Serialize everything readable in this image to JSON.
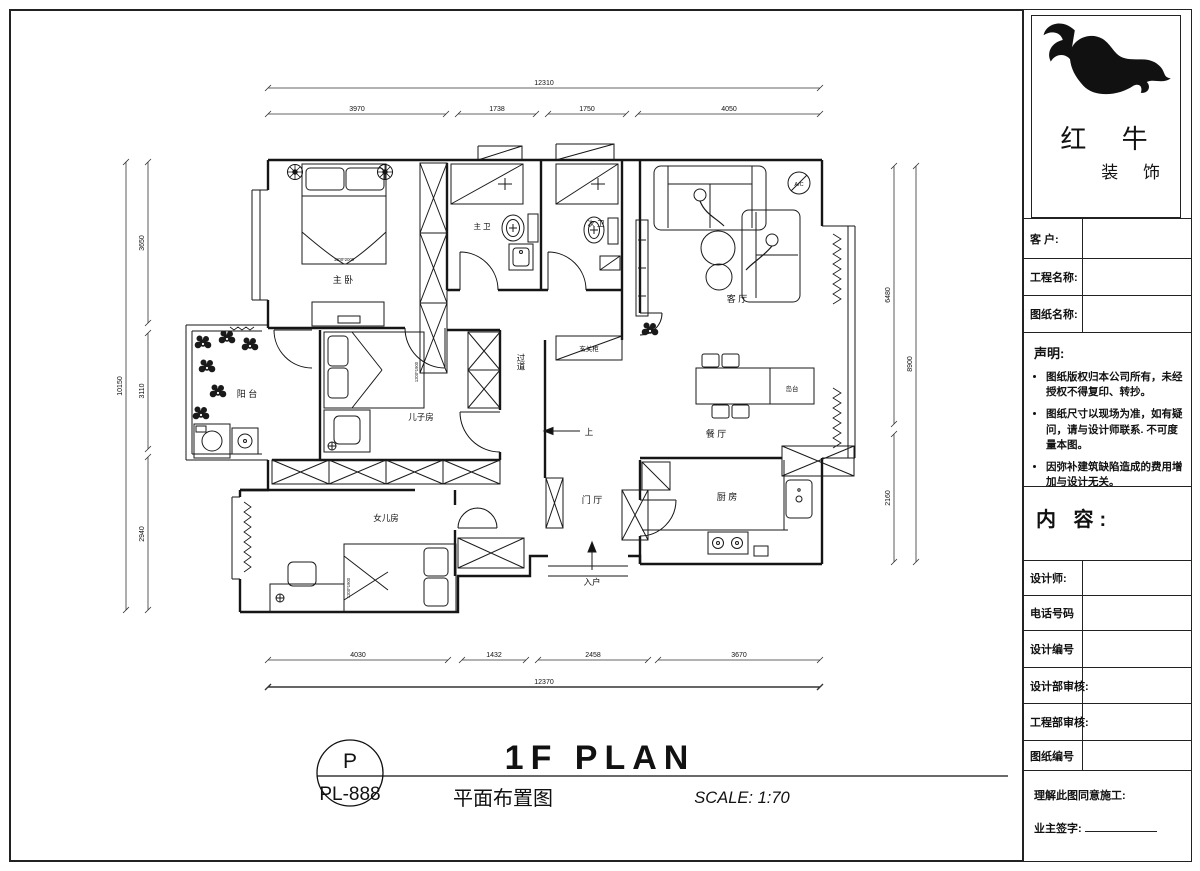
{
  "sheet_footer": {
    "code_top": "P",
    "code_bottom": "PL-888",
    "title_en": "1F PLAN",
    "title_cn": "平面布置图",
    "scale": "SCALE: 1:70"
  },
  "title_block": {
    "brand_name": "红 牛",
    "brand_sub": "装 饰",
    "logo": "bull-logo",
    "fields_top": [
      "客  户:",
      "工程名称:",
      "图纸名称:"
    ],
    "statement_heading": "声明:",
    "statement_items": [
      "图纸版权归本公司所有，未经授权不得复印、转抄。",
      "图纸尺寸以现场为准，如有疑问，请与设计师联系. 不可度量本图。",
      "因弥补建筑缺陷造成的费用增加与设计无关。"
    ],
    "content_label": "内 容:",
    "fields_bottom": [
      "设计师:",
      "电话号码",
      "设计编号",
      "设计部审核:",
      "工程部审核:",
      "图纸编号"
    ],
    "approval_line": "理解此图同意施工:",
    "signature_label": "业主签字:"
  },
  "plan": {
    "room_labels": {
      "master_bedroom": "主 卧",
      "master_bath": "主 卫",
      "second_bath": "次 卫",
      "living_room": "客 厅",
      "balcony": "阳 台",
      "son_room": "儿子房",
      "corridor": "过道",
      "entry_cabinet": "玄关柜",
      "dining_room": "餐 厅",
      "island": "岛台",
      "kitchen": "厨 房",
      "foyer": "门 厅",
      "daughter_room": "女儿房",
      "entrance": "入户",
      "up": "上",
      "ac": "A/C"
    },
    "furniture_labels": {
      "master_bed_size": "1800*2000",
      "son_bed_size": "1200*1900",
      "daughter_bed_size": "1200*1900"
    },
    "dimensions": {
      "top_total": "12310",
      "top_segments": [
        "3970",
        "1738",
        "1750",
        "4050"
      ],
      "bottom_segments": [
        "4030",
        "1432",
        "2458",
        "3670"
      ],
      "bottom_total": "12370",
      "left_segments": [
        "3650",
        "3110",
        "2940"
      ],
      "left_total": "10150",
      "right_segments": [
        "6480",
        "2160"
      ],
      "right_total": "8900"
    }
  }
}
